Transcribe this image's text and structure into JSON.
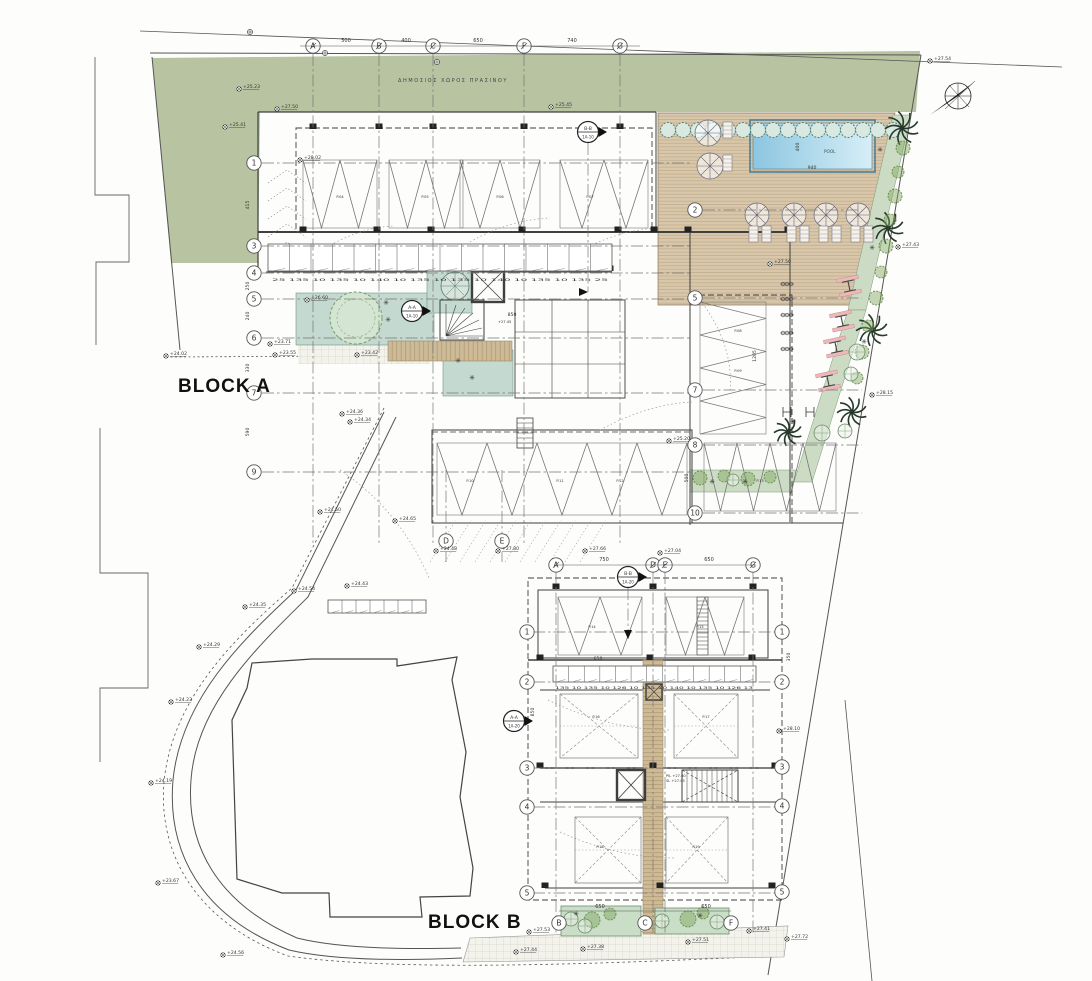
{
  "labels": {
    "block_a": "BLOCK A",
    "block_b": "BLOCK B",
    "pool": "POOL",
    "public_green": "ΔΗΜΟΣΙΟΣ ΧΩΡΟΣ ΠΡΑΣΙΝΟΥ"
  },
  "colors": {
    "green_area": "#b7c3a1",
    "teal_court": "#c4d9cf",
    "plant_strip": "#ccdcc4",
    "planter": "#c9ddc7",
    "deck": "#d8c7aa",
    "deck_line": "#c0ab8a",
    "walk": "#cdbb97",
    "walk_line": "#b29a74",
    "pool_dark": "#8cc6e0",
    "pool_light": "#d6eef7",
    "pool_edge": "#4d7f99",
    "hedge_fill": "#d9e8e0",
    "hedge_stroke": "#54857d",
    "shrub": "#7da55c",
    "palm": "#27392b",
    "pink": "#ecb9bb"
  },
  "grid": {
    "a_top": {
      "y": 46,
      "letters": [
        {
          "l": "A",
          "x": 313
        },
        {
          "l": "B",
          "x": 379
        },
        {
          "l": "C",
          "x": 433
        },
        {
          "l": "F",
          "x": 524
        },
        {
          "l": "G",
          "x": 620
        }
      ],
      "dims": [
        {
          "t": "500",
          "x": 346
        },
        {
          "t": "400",
          "x": 406
        },
        {
          "t": "650",
          "x": 478
        },
        {
          "t": "740",
          "x": 572
        }
      ]
    },
    "a_left": {
      "x": 254,
      "rows": [
        {
          "l": "1",
          "y": 163
        },
        {
          "l": "3",
          "y": 246
        },
        {
          "l": "4",
          "y": 273
        },
        {
          "l": "5",
          "y": 299
        },
        {
          "l": "6",
          "y": 338
        },
        {
          "l": "7",
          "y": 393
        },
        {
          "l": "9",
          "y": 472
        }
      ]
    },
    "a_mid": {
      "x": 695,
      "rows": [
        {
          "l": "2",
          "y": 210
        },
        {
          "l": "5",
          "y": 298
        },
        {
          "l": "7",
          "y": 390
        },
        {
          "l": "8",
          "y": 445
        },
        {
          "l": "10",
          "y": 513
        }
      ]
    },
    "a_bottom": {
      "y": 541,
      "letters": [
        {
          "l": "D",
          "x": 446
        },
        {
          "l": "E",
          "x": 502
        }
      ]
    },
    "b_top": {
      "y": 565,
      "letters": [
        {
          "l": "A",
          "x": 556
        },
        {
          "l": "D",
          "x": 653
        },
        {
          "l": "E",
          "x": 665
        },
        {
          "l": "G",
          "x": 753
        }
      ],
      "dims": [
        {
          "t": "750",
          "x": 604
        },
        {
          "t": "650",
          "x": 709
        }
      ]
    },
    "b_left": {
      "x": 527,
      "rows": [
        {
          "l": "1",
          "y": 632
        },
        {
          "l": "2",
          "y": 682
        },
        {
          "l": "3",
          "y": 768
        },
        {
          "l": "4",
          "y": 807
        },
        {
          "l": "5",
          "y": 893
        }
      ]
    },
    "b_right": {
      "x": 782,
      "rows": [
        {
          "l": "1",
          "y": 632
        },
        {
          "l": "2",
          "y": 682
        },
        {
          "l": "3",
          "y": 767
        },
        {
          "l": "4",
          "y": 806
        },
        {
          "l": "5",
          "y": 892
        }
      ]
    },
    "b_bottom": {
      "y": 923,
      "letters": [
        {
          "l": "B",
          "x": 559
        },
        {
          "l": "C",
          "x": 645
        },
        {
          "l": "F",
          "x": 731
        }
      ],
      "dims": [
        {
          "t": "650",
          "x": 600
        },
        {
          "t": "650",
          "x": 706
        }
      ]
    }
  },
  "sections": [
    {
      "label": "B-B",
      "ref": "1A-10",
      "x": 588,
      "y": 132,
      "stem": "down-long"
    },
    {
      "label": "A-A",
      "ref": "1A-10",
      "x": 412,
      "y": 311,
      "stem": "none"
    },
    {
      "label": "B-B",
      "ref": "1A-20",
      "x": 628,
      "y": 577,
      "stem": "down"
    },
    {
      "label": "A-A",
      "ref": "1A-20",
      "x": 514,
      "y": 721,
      "stem": "none"
    }
  ],
  "dimensions": [
    {
      "t": "940",
      "x": 812,
      "y": 169,
      "r": 0
    },
    {
      "t": "400",
      "x": 799,
      "y": 147,
      "r": -90
    },
    {
      "t": "415",
      "x": 249,
      "y": 205,
      "r": -90
    },
    {
      "t": "250",
      "x": 249,
      "y": 286,
      "r": -90
    },
    {
      "t": "240",
      "x": 249,
      "y": 316,
      "r": -90
    },
    {
      "t": "330",
      "x": 249,
      "y": 368,
      "r": -90
    },
    {
      "t": "590",
      "x": 249,
      "y": 432,
      "r": -90
    },
    {
      "t": "1205",
      "x": 756,
      "y": 356,
      "r": -90
    },
    {
      "t": "500",
      "x": 688,
      "y": 478,
      "r": -90
    },
    {
      "t": "350",
      "x": 790,
      "y": 657,
      "r": -90
    },
    {
      "t": "850",
      "x": 534,
      "y": 712,
      "r": -90
    },
    {
      "t": "850",
      "x": 512,
      "y": 316,
      "r": 0
    },
    {
      "t": "650",
      "x": 598,
      "y": 660,
      "r": 0
    }
  ],
  "tiny_dim_rows": [
    {
      "t": "25 135 10 135 10 140 10 135 10 135 10 140 10 135 10 135 25",
      "x": 272,
      "y": 281,
      "len": 336
    },
    {
      "t": "135 10 135 10 126 10 135 10 140 10 135 10 126 13",
      "x": 555,
      "y": 689,
      "len": 198
    }
  ],
  "spot_elevations": [
    [
      "+25.23",
      239,
      89
    ],
    [
      "+25.41",
      225,
      127
    ],
    [
      "+27.50",
      277,
      109
    ],
    [
      "+25.45",
      551,
      107
    ],
    [
      "+27.54",
      930,
      61
    ],
    [
      "+27.43",
      898,
      247
    ],
    [
      "+28.15",
      872,
      395
    ],
    [
      "+26.60",
      307,
      300
    ],
    [
      "+23.71",
      270,
      344
    ],
    [
      "+24.02",
      166,
      356
    ],
    [
      "+23.55",
      275,
      355
    ],
    [
      "+23.42",
      357,
      355
    ],
    [
      "+24.36",
      342,
      414
    ],
    [
      "+24.34",
      350,
      422
    ],
    [
      "+25.20",
      669,
      441
    ],
    [
      "+24.54",
      294,
      591
    ],
    [
      "+24.35",
      245,
      607
    ],
    [
      "+24.29",
      199,
      647
    ],
    [
      "+24.23",
      171,
      702
    ],
    [
      "+24.19",
      151,
      783
    ],
    [
      "+23.67",
      158,
      883
    ],
    [
      "+24.56",
      223,
      955
    ],
    [
      "+24.50",
      320,
      512
    ],
    [
      "+24.65",
      395,
      521
    ],
    [
      "+24.43",
      347,
      586
    ],
    [
      "+24.48",
      436,
      551
    ],
    [
      "+27.80",
      498,
      551
    ],
    [
      "+27.66",
      585,
      551
    ],
    [
      "+27.04",
      660,
      553
    ],
    [
      "+28.10",
      779,
      731
    ],
    [
      "+27.53",
      529,
      932
    ],
    [
      "+27.44",
      516,
      952
    ],
    [
      "+27.38",
      583,
      949
    ],
    [
      "+27.51",
      688,
      942
    ],
    [
      "+27.41",
      749,
      931
    ],
    [
      "+27.72",
      787,
      939
    ],
    [
      "+28.02",
      300,
      160
    ],
    [
      "+27.50",
      770,
      264
    ]
  ],
  "parking_labels": [
    [
      "P.04",
      340,
      198
    ],
    [
      "P.05",
      425,
      198
    ],
    [
      "P.06",
      500,
      198
    ],
    [
      "P.07",
      590,
      198
    ],
    [
      "P.08",
      738,
      332
    ],
    [
      "P.09",
      738,
      372
    ],
    [
      "P.10",
      470,
      482
    ],
    [
      "P.11",
      560,
      482
    ],
    [
      "P.12",
      620,
      482
    ],
    [
      "P.13",
      760,
      482
    ],
    [
      "P.14",
      592,
      628
    ],
    [
      "P.15",
      700,
      628
    ],
    [
      "P.16",
      596,
      718
    ],
    [
      "P.17",
      706,
      718
    ],
    [
      "P.18",
      600,
      848
    ],
    [
      "P.19",
      696,
      848
    ]
  ],
  "core_texts": [
    [
      "+27.45",
      498,
      323
    ],
    [
      "PIL +27.60",
      666,
      777
    ],
    [
      "SL +27.45",
      666,
      782
    ]
  ]
}
